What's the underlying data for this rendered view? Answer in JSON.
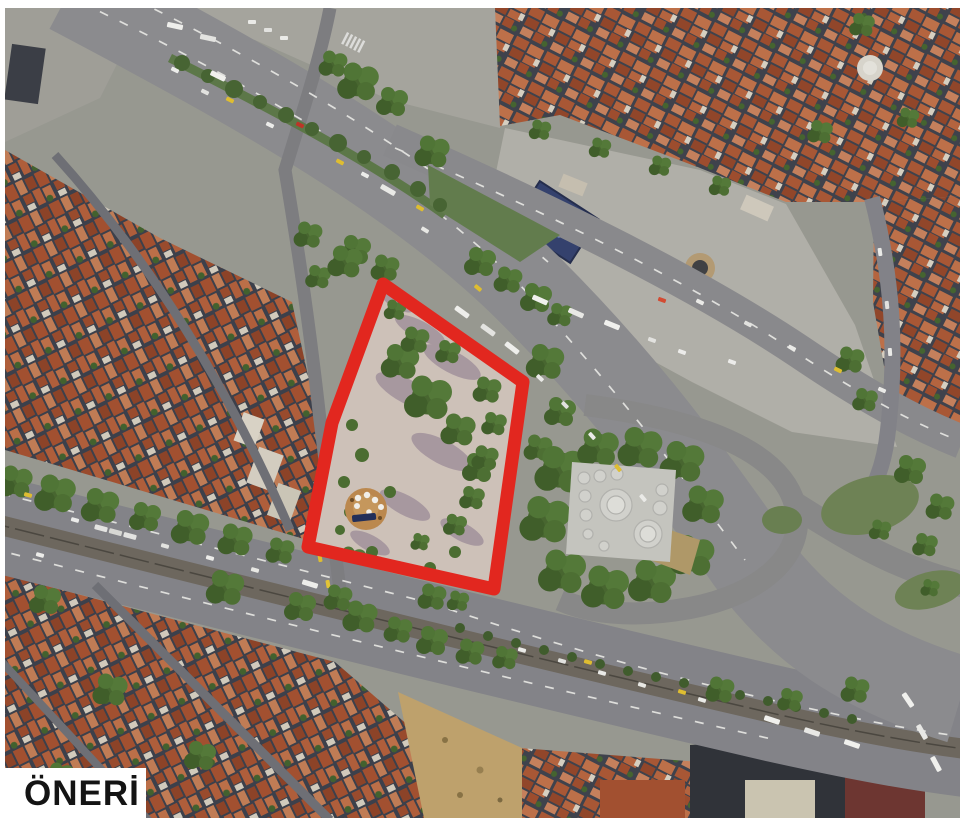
{
  "page": {
    "background_color": "#ffffff"
  },
  "map": {
    "type": "satellite-aerial-photo-with-proposal-overlay",
    "label": "ÖNERİ",
    "colors": {
      "site_boundary": "#e8251d",
      "park_ground": "#d2c5bc",
      "park_trees": "#4a6e2f",
      "park_shadows": "#a4939e",
      "plaza_circle": "#bf8a4e",
      "canopy_navy": "#202d59",
      "roads": "#8b8b8d",
      "rooftops": "#a5502e",
      "plaza_concrete": "#b4b2ab",
      "label_text": "#141414",
      "label_background": "#ffffff"
    },
    "visible_features": [
      "red polygon boundary around proposal site",
      "landscaped park render with tree clusters, shadows and circular plaza with white canopies",
      "tree-lined boulevard with traffic (upper)",
      "tram corridor boulevard with traffic (lower)",
      "large concrete plaza with parked buses",
      "blue-roofed building on plaza",
      "domed historic bath building surrounded by trees",
      "grass interchange islands",
      "dense red-tiled rooftop blocks",
      "construction site",
      "dark modern building block"
    ]
  }
}
